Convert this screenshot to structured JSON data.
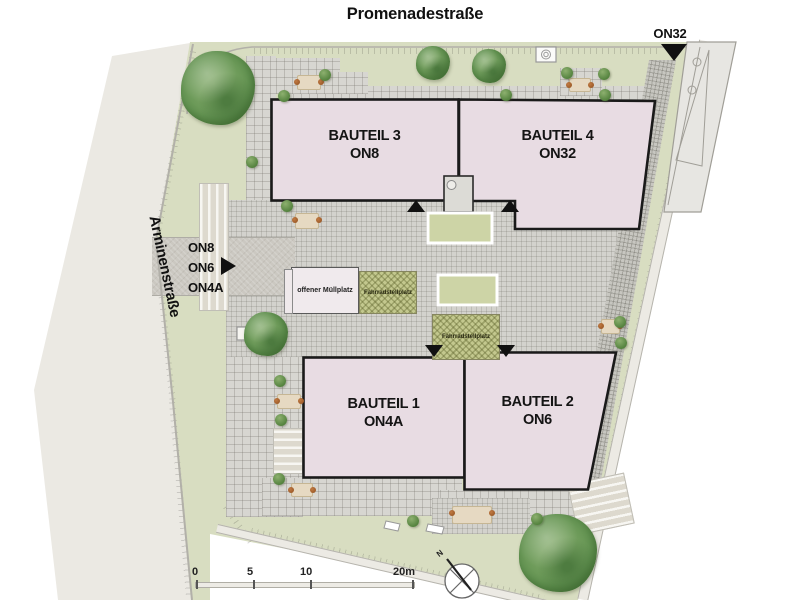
{
  "streets": {
    "promenade": "Promenadestraße",
    "arminen": "Arminenstraße"
  },
  "buildings": [
    {
      "name": "BAUTEIL 3",
      "unit": "ON8"
    },
    {
      "name": "BAUTEIL 4",
      "unit": "ON32"
    },
    {
      "name": "BAUTEIL 1",
      "unit": "ON4A"
    },
    {
      "name": "BAUTEIL 2",
      "unit": "ON6"
    }
  ],
  "entrances": {
    "top_right_unit": "ON32",
    "left_units": [
      "ON8",
      "ON6",
      "ON4A"
    ]
  },
  "facilities": {
    "muellplatz": "offener Müllplatz",
    "fahrradstellplatz_1": "Fahrradstellplatz",
    "fahrradstellplatz_2": "Fahrradstellplatz"
  },
  "scalebar": {
    "tick_0": "0",
    "tick_5": "5",
    "tick_10": "10",
    "tick_20": "20m"
  },
  "compass": {
    "north": "N"
  },
  "colors": {
    "lawn": "#d8ddc1",
    "street": "#ebe9e3",
    "paving_grid": "#d7d6d1",
    "building_fill": "#e8dce3",
    "building_outline": "#1a1a1a",
    "bike_hatch": "#c3c88e",
    "marker_black": "#111111",
    "tree_green": "#649452"
  }
}
